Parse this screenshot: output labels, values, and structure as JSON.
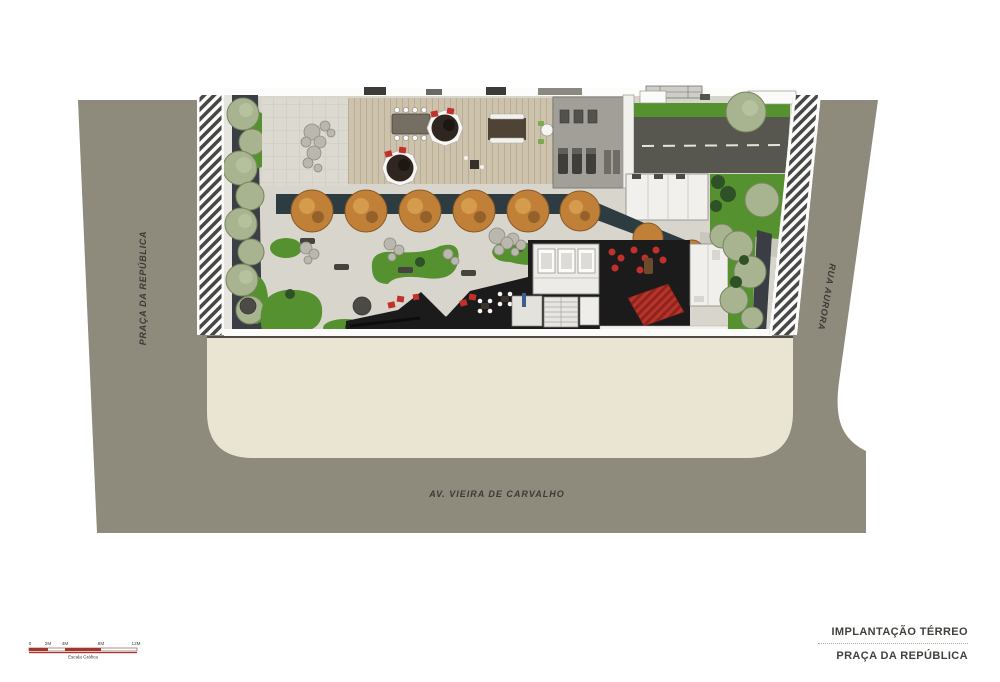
{
  "document": {
    "type": "architectural-site-plan",
    "sheet_background": "#ffffff"
  },
  "streets": {
    "left_label": "PRAÇA DA REPÚBLICA",
    "right_label": "RUA AURORA",
    "bottom_label": "AV. VIEIRA DE CARVALHO"
  },
  "title_block": {
    "line1": "IMPLANTAÇÃO TÉRREO",
    "line2": "PRAÇA DA REPÚBLICA"
  },
  "scale_bar": {
    "tick_labels": [
      "0",
      "2M",
      "4M",
      "8M",
      "12M"
    ],
    "caption": "Escala Gráfica"
  },
  "colors": {
    "street": "#8e8a7c",
    "lot": "#eae5d3",
    "pavement": "#d8d5cd",
    "deck": "#cdc3ad",
    "drive": "#57564f",
    "green": "#55922f",
    "sage": "#a7b48f",
    "autumn": "#c08038",
    "teal": "#2d3c41",
    "dark": "#1b1b1b",
    "red": "#c2302c",
    "scalered": "#a5342c",
    "text": "#3b3a36"
  }
}
